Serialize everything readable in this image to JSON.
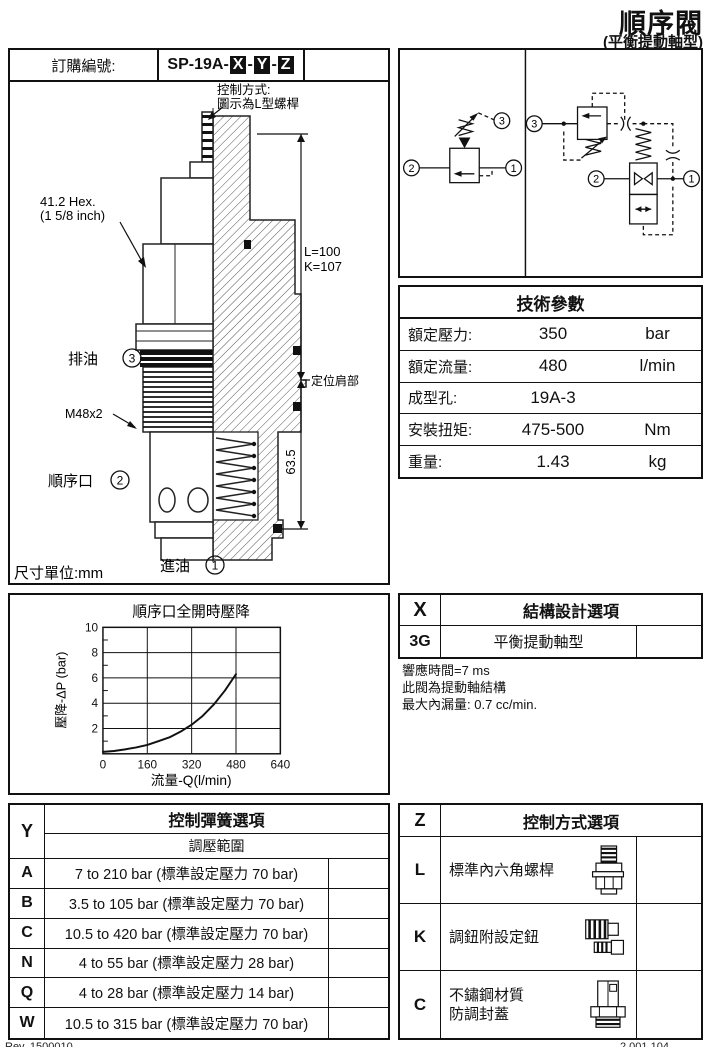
{
  "page": {
    "title": "順序閥",
    "subtitle": "(平衡提動軸型)",
    "footer_left": "Rev. 1500010",
    "footer_right": "2.001.104"
  },
  "order": {
    "label": "訂購編號:",
    "code_prefix": "SP-19A-",
    "separator": "-",
    "code_x": "X",
    "code_y": "Y",
    "code_z": "Z"
  },
  "drawing": {
    "control_note_1": "控制方式:",
    "control_note_2": "圖示為L型螺桿",
    "hex_label_1": "41.2 Hex.",
    "hex_label_2": "(1 5/8 inch)",
    "thread_label": "M48x2",
    "port3_label": "排油",
    "port3_num": "3",
    "port2_label": "順序口",
    "port2_num": "2",
    "port1_label": "進油",
    "port1_num": "1",
    "dim_l": "L=100",
    "dim_k": "K=107",
    "shoulder_label": "定位肩部",
    "dim_635": "63.5",
    "unit_label": "尺寸單位:mm"
  },
  "circuit": {
    "left": {
      "port1": "1",
      "port2": "2",
      "port3": "3"
    },
    "right": {
      "port1": "1",
      "port2": "2",
      "port3": "3"
    }
  },
  "tech_params": {
    "title": "技術參數",
    "rows": [
      {
        "label": "額定壓力:",
        "value": "350",
        "unit": "bar"
      },
      {
        "label": "額定流量:",
        "value": "480",
        "unit": "l/min"
      },
      {
        "label": "成型孔:",
        "value": "19A-3",
        "unit": ""
      },
      {
        "label": "安裝扭矩:",
        "value": "475-500",
        "unit": "Nm"
      },
      {
        "label": "重量:",
        "value": "1.43",
        "unit": "kg"
      }
    ]
  },
  "chart_data": {
    "type": "line",
    "title": "順序口全開時壓降",
    "xlabel": "流量-Q(l/min)",
    "ylabel": "壓降-ΔP (bar)",
    "xlim": [
      0,
      640
    ],
    "ylim": [
      0,
      10
    ],
    "xticks": [
      0,
      160,
      320,
      480,
      640
    ],
    "yticks": [
      2,
      4,
      6,
      8,
      10
    ],
    "grid": true,
    "series": [
      {
        "name": "pressure-drop",
        "x": [
          0,
          40,
          80,
          120,
          160,
          200,
          240,
          280,
          320,
          360,
          400,
          440,
          480
        ],
        "y": [
          0.15,
          0.22,
          0.35,
          0.5,
          0.7,
          1.0,
          1.3,
          1.75,
          2.3,
          3.0,
          3.9,
          5.0,
          6.3
        ]
      }
    ]
  },
  "x_options": {
    "code": "X",
    "title": "結構設計選項",
    "rows": [
      {
        "code": "3G",
        "label": "平衡提動軸型"
      }
    ],
    "notes": [
      "響應時間=7 ms",
      "此閥為提動軸結構",
      "最大內漏量: 0.7 cc/min."
    ]
  },
  "y_options": {
    "code": "Y",
    "title": "控制彈簧選項",
    "subtitle": "調壓範圍",
    "rows": [
      {
        "code": "A",
        "label": "7 to 210 bar  (標準設定壓力 70 bar)"
      },
      {
        "code": "B",
        "label": "3.5 to 105 bar (標準設定壓力 70 bar)"
      },
      {
        "code": "C",
        "label": "10.5 to 420 bar (標準設定壓力 70 bar)"
      },
      {
        "code": "N",
        "label": "4 to 55  bar  (標準設定壓力 28 bar)"
      },
      {
        "code": "Q",
        "label": "4 to 28  bar  (標準設定壓力 14 bar)"
      },
      {
        "code": "W",
        "label": "10.5 to 315 bar (標準設定壓力 70 bar)"
      }
    ]
  },
  "z_options": {
    "code": "Z",
    "title": "控制方式選項",
    "rows": [
      {
        "code": "L",
        "label1": "標準內六角螺桿",
        "label2": "",
        "icon": "hex-screw-icon"
      },
      {
        "code": "K",
        "label1": "調鈕附設定鈕",
        "label2": "",
        "icon": "knob-icon"
      },
      {
        "code": "C",
        "label1": "不鏽鋼材質",
        "label2": "防調封蓋",
        "icon": "sealed-cap-icon"
      }
    ]
  }
}
